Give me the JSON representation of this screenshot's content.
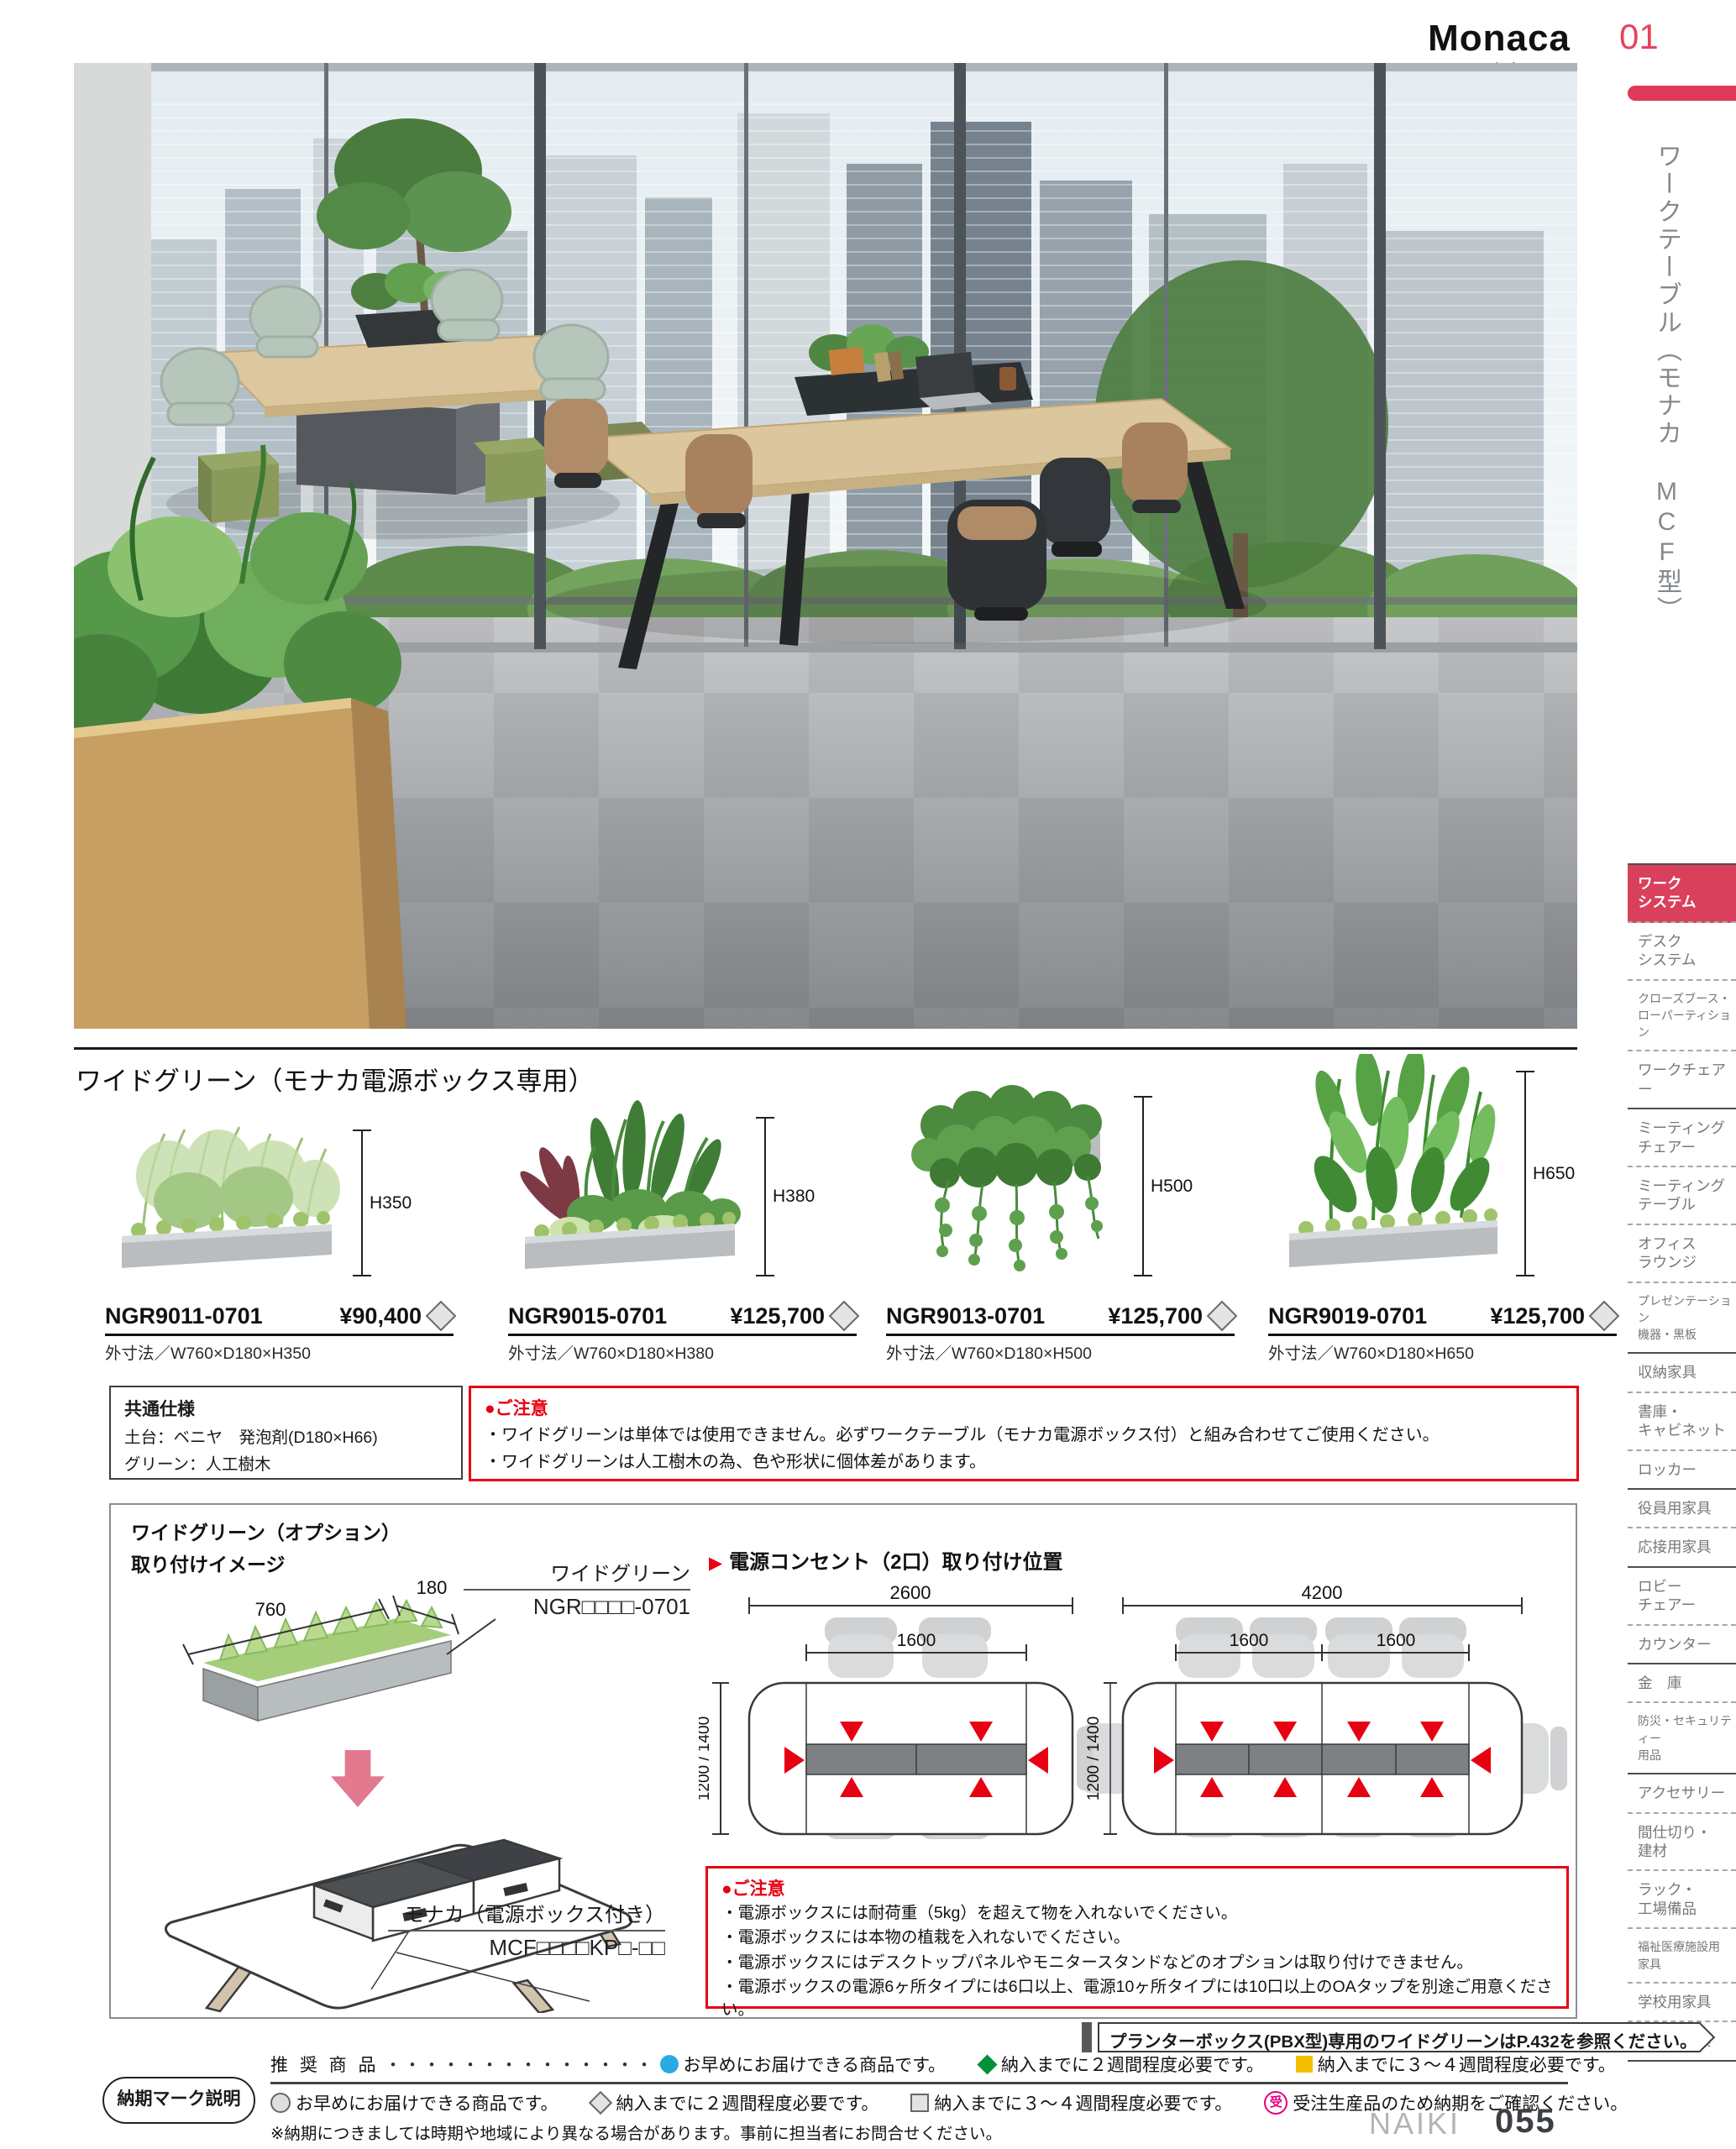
{
  "header": {
    "brand": "Monaca",
    "brand_sub": "モナカ",
    "page_num": "01",
    "side_title": "ワークテーブル（モナカ MCF型）"
  },
  "sidebar": {
    "items": [
      {
        "label": "ワーク\nシステム",
        "active": true
      },
      {
        "label": "デスク\nシステム"
      },
      {
        "label": "クローズブース・\nローパーティション"
      },
      {
        "label": "ワークチェアー"
      },
      {
        "label": "ミーティング\nチェアー"
      },
      {
        "label": "ミーティング\nテーブル"
      },
      {
        "label": "オフィス\nラウンジ"
      },
      {
        "label": "プレゼンテーション\n機器・黒板"
      },
      {
        "label": "収納家具"
      },
      {
        "label": "書庫・\nキャビネット"
      },
      {
        "label": "ロッカー"
      },
      {
        "label": "役員用家具"
      },
      {
        "label": "応接用家具"
      },
      {
        "label": "ロビー\nチェアー"
      },
      {
        "label": "カウンター"
      },
      {
        "label": "金　庫"
      },
      {
        "label": "防災・セキュリティー\n用品"
      },
      {
        "label": "アクセサリー"
      },
      {
        "label": "間仕切り・\n建材"
      },
      {
        "label": "ラック・\n工場備品"
      },
      {
        "label": "福祉医療施設用\n家具"
      },
      {
        "label": "学校用家具"
      },
      {
        "label": "店舗用家具"
      }
    ]
  },
  "section": {
    "title": "ワイドグリーン（モナカ電源ボックス専用）"
  },
  "products": [
    {
      "code": "NGR9011-0701",
      "price": "¥90,400",
      "dims": "外寸法／W760×D180×H350",
      "height_label": "H350"
    },
    {
      "code": "NGR9015-0701",
      "price": "¥125,700",
      "dims": "外寸法／W760×D180×H380",
      "height_label": "H380"
    },
    {
      "code": "NGR9013-0701",
      "price": "¥125,700",
      "dims": "外寸法／W760×D180×H500",
      "height_label": "H500"
    },
    {
      "code": "NGR9019-0701",
      "price": "¥125,700",
      "dims": "外寸法／W760×D180×H650",
      "height_label": "H650"
    }
  ],
  "spec_box": {
    "title": "共通仕様",
    "line1": "土台：ベニヤ　発泡剤(D180×H66)",
    "line2": "グリーン：人工樹木"
  },
  "notice1": {
    "title": "●ご注意",
    "line1": "・ワイドグリーンは単体では使用できません。必ずワークテーブル（モナカ電源ボックス付）と組み合わせてご使用ください。",
    "line2": "・ワイドグリーンは人工樹木の為、色や形状に個体差があります。"
  },
  "diagram": {
    "title1": "ワイドグリーン（オプション）",
    "title2": "取り付けイメージ",
    "dim_w": "760",
    "dim_d": "180",
    "green_label": "ワイドグリーン",
    "green_code": "NGR□□□□-0701",
    "table_label": "モナカ（電源ボックス付き）",
    "table_code": "MCF□□□□KP□-□□",
    "outlet_title": "電源コンセント（2口）取り付け位置",
    "tableA": {
      "total": "2600",
      "inner": "1600",
      "depth": "1200 / 1400"
    },
    "tableB": {
      "total": "4200",
      "inner1": "1600",
      "inner2": "1600",
      "depth": "1200 / 1400"
    },
    "notice2": {
      "title": "●ご注意",
      "line1": "・電源ボックスには耐荷重（5kg）を超えて物を入れないでください。",
      "line2": "・電源ボックスには本物の植栽を入れないでください。",
      "line3": "・電源ボックスにはデスクトップパネルやモニタースタンドなどのオプションは取り付けできません。",
      "line4": "・電源ボックスの電源6ヶ所タイプには6口以上、電源10ヶ所タイプには10口以上のOAタップを別途ご用意ください。"
    }
  },
  "banner": {
    "text": "プランターボックス(PBX型)専用のワイドグリーンはP.432を参照ください。"
  },
  "footer": {
    "legend_title": "納期マーク説明",
    "row1_label": "推 奨 商 品",
    "dots": "・・・・・・・・・・・・・・",
    "row1": [
      {
        "shape": "circle-filled",
        "color": "#29abe2",
        "text": "お早めにお届けできる商品です。"
      },
      {
        "shape": "diamond-filled",
        "color": "#00913a",
        "text": "納入までに２週間程度必要です。"
      },
      {
        "shape": "square-filled",
        "color": "#f3c000",
        "text": "納入までに３～４週間程度必要です。"
      }
    ],
    "row2": [
      {
        "shape": "circle-outline",
        "text": "お早めにお届けできる商品です。"
      },
      {
        "shape": "diamond-outline",
        "text": "納入までに２週間程度必要です。"
      },
      {
        "shape": "square-outline",
        "text": "納入までに３～４週間程度必要です。"
      },
      {
        "shape": "ju-mark",
        "mark": "受",
        "color": "#e4007f",
        "text": "受注生産品のため納期をご確認ください。"
      }
    ],
    "note": "※納期につきましては時期や地域により異なる場合があります。事前に担当者にお問合せください。",
    "brand": "NAIKI",
    "page": "055"
  }
}
